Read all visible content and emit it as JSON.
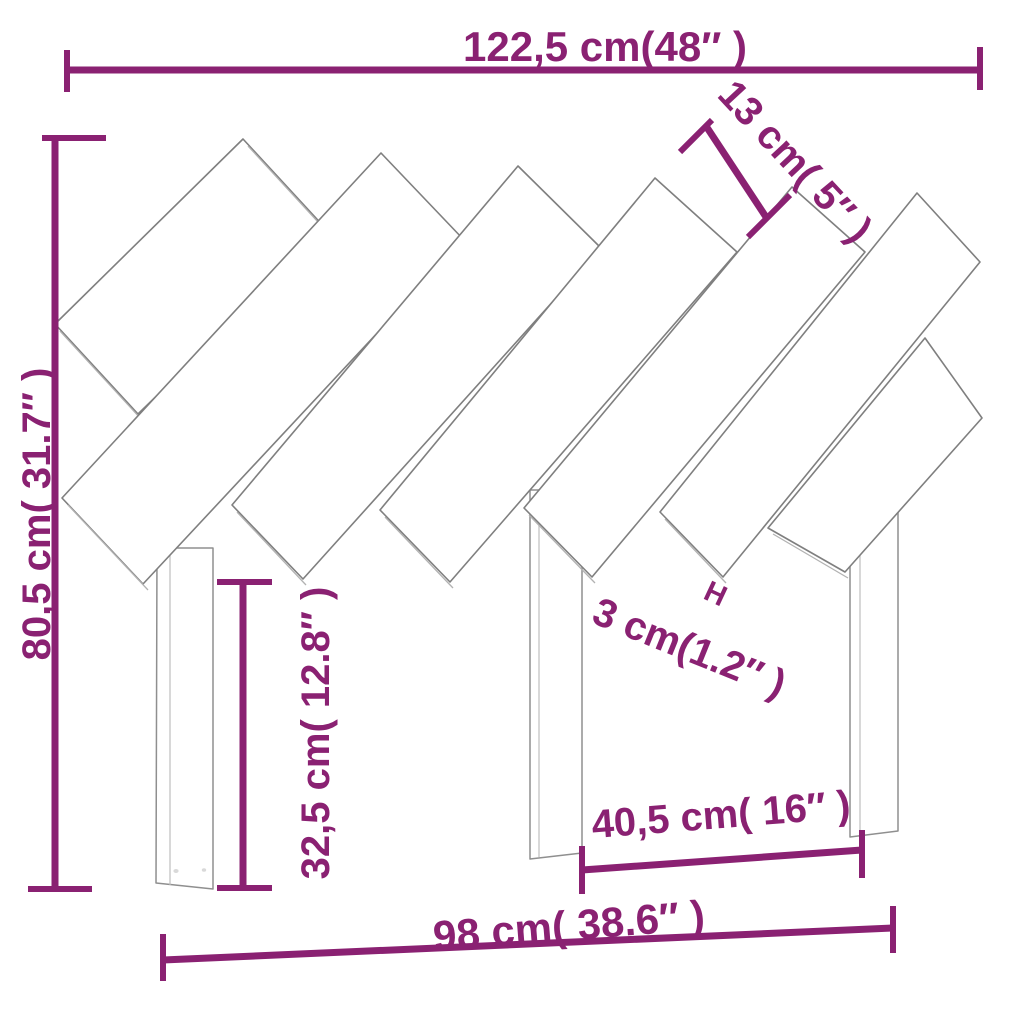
{
  "diagram": {
    "title": "Headboard dimension diagram",
    "accent_color": "#8A2172",
    "drawing_line_color": "#7f7f7f",
    "background_color": "#ffffff"
  },
  "dimensions": {
    "total_width": {
      "label": "122,5 cm(48″ )"
    },
    "slat_width": {
      "label": "13 cm( 5″ )"
    },
    "total_height": {
      "label": "80,5 cm( 31.7″ )"
    },
    "leg_height": {
      "label": "32,5 cm( 12.8″ )"
    },
    "slat_gap": {
      "label": "3 cm(1.2″ )",
      "marker": "H"
    },
    "leg_spacing": {
      "label": "40,5 cm( 16″ )"
    },
    "base_width": {
      "label": "98 cm( 38.6″ )"
    }
  }
}
